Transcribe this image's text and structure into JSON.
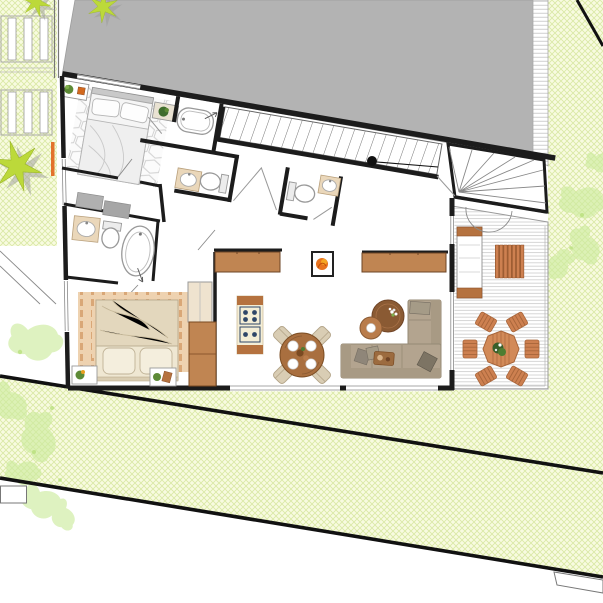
{
  "title": "apartment floor plan with terrace and garden",
  "colors": {
    "background": "#ffffff",
    "garden_base": "#f8fbe0",
    "garden_hatch": "#d9e8a4",
    "boundary": "#111111",
    "building_gray": "#b3b3b3",
    "wall": "#1c1c1c",
    "wood_cabinet": "#c08552",
    "wood_dark": "#8a5a33",
    "wood_mid": "#a96f3f",
    "terrace_wood": "#cd8050",
    "deck_line": "#cccccc",
    "sofa": "#b3a48f",
    "sofa_dark": "#8f8679",
    "bed_white": "#f5f5f5",
    "bed_cream": "#e9dec8",
    "rug_tan": "#eed2b0",
    "rug_dash": "#d9a777",
    "runner_end": "#b5723f",
    "runner_field": "#f4eed6",
    "runner_dot": "#2e4668",
    "fixture_counter": "#ead7ba",
    "plant_star": "#bcd93a",
    "plant_soft": "#cdeb9e",
    "flame": "#e8731e",
    "chair_beige": "#d9cdb4",
    "shadow_gray": "#9a9a9a"
  },
  "elements": [
    "neighbor building mass",
    "pergola slats",
    "agave plants",
    "garden crosshatch",
    "site boundary lines",
    "master bedroom bed",
    "hexagon rug",
    "ensuite bathtub",
    "sinks",
    "toilets",
    "straight staircase",
    "winder staircase",
    "section marker",
    "storage closet",
    "second bedroom bed",
    "wardrobe",
    "kitchen sideboards",
    "wood stove",
    "runner rug",
    "round dining table with four chairs",
    "coffee tables",
    "corner sofa",
    "terrace decking",
    "lounge chair",
    "slatted bench",
    "outdoor dining table with six chairs",
    "door swing arcs"
  ]
}
